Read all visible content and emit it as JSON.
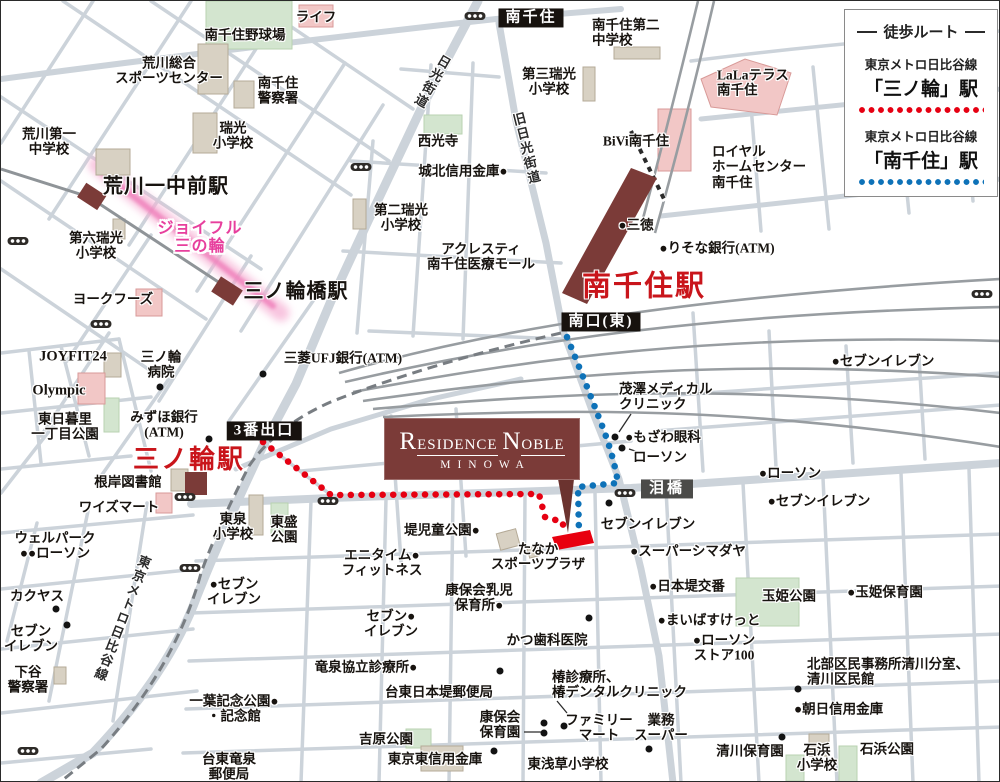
{
  "legend": {
    "title": "徒歩ルート",
    "entries": [
      {
        "line": "東京メトロ日比谷線",
        "station": "「三ノ輪」駅",
        "color": "#e60012"
      },
      {
        "line": "東京メトロ日比谷線",
        "station": "「南千住」駅",
        "color": "#0e72b8"
      }
    ]
  },
  "logo": {
    "part1": "R",
    "part2": "ESIDENCE",
    "part3": "N",
    "part4": "OBLE",
    "subtitle": "MINOWA"
  },
  "colors": {
    "red_route": "#e60012",
    "blue_route": "#0e72b8",
    "station_red": "#c9151b",
    "joyful_pink": "#e73f9d",
    "building_maroon": "#7b3b38"
  },
  "labels": [
    {
      "t": "ライフ",
      "x": 315,
      "y": 16
    },
    {
      "t": "南千住野球場",
      "x": 244,
      "y": 34
    },
    {
      "t": "荒川総合\nスポーツセンター",
      "x": 168,
      "y": 70
    },
    {
      "t": "南千住\n警察署",
      "x": 277,
      "y": 90
    },
    {
      "t": "荒川第一\n中学校",
      "x": 48,
      "y": 141
    },
    {
      "t": "瑞光\n小学校",
      "x": 232,
      "y": 135
    },
    {
      "t": "荒川一中前駅",
      "x": 165,
      "y": 186,
      "cls": "st"
    },
    {
      "t": "ジョイフル\n三の輪",
      "x": 199,
      "y": 237,
      "cls": "joyful"
    },
    {
      "t": "第六瑞光\n小学校",
      "x": 95,
      "y": 245
    },
    {
      "t": "ヨークフーズ",
      "x": 112,
      "y": 298
    },
    {
      "t": "三ノ輪橋駅",
      "x": 295,
      "y": 291,
      "cls": "st"
    },
    {
      "t": "南千住",
      "x": 530,
      "y": 17,
      "cls": "box"
    },
    {
      "t": "日光街道",
      "x": 430,
      "y": 80,
      "cls": "road",
      "rot": 30
    },
    {
      "t": "南千住第二\n中学校",
      "x": 591,
      "y": 32,
      "la": 1
    },
    {
      "t": "第三瑞光\n小学校",
      "x": 548,
      "y": 81
    },
    {
      "t": "第二瑞光\n小学校",
      "x": 400,
      "y": 217
    },
    {
      "t": "西光寺",
      "x": 437,
      "y": 140
    },
    {
      "t": "城北信用金庫●",
      "x": 462,
      "y": 170
    },
    {
      "t": "旧日光街道",
      "x": 524,
      "y": 148,
      "cls": "road",
      "rot": -14
    },
    {
      "t": "BiVi南千住",
      "x": 635,
      "y": 140
    },
    {
      "t": "LaLaテラス\n南千住",
      "x": 716,
      "y": 82,
      "la": 1
    },
    {
      "t": "ロイヤル\nホームセンター\n南千住",
      "x": 711,
      "y": 166,
      "la": 1
    },
    {
      "t": "●三徳",
      "x": 635,
      "y": 224
    },
    {
      "t": "●りそな銀行(ATM)",
      "x": 716,
      "y": 247
    },
    {
      "t": "アクレスティ\n南千住医療モール",
      "x": 480,
      "y": 256
    },
    {
      "t": "南千住駅",
      "x": 643,
      "y": 286,
      "cls": "stbig",
      "s": 29
    },
    {
      "t": "南口(東)",
      "x": 600,
      "y": 321,
      "cls": "box"
    },
    {
      "t": "JOYFIT24",
      "x": 72,
      "y": 356,
      "cls": "en"
    },
    {
      "t": "三ノ輪\n病院",
      "x": 160,
      "y": 364
    },
    {
      "t": "Olympic",
      "x": 58,
      "y": 390,
      "cls": "en"
    },
    {
      "t": "東日暮里\n一丁目公園",
      "x": 64,
      "y": 426
    },
    {
      "t": "みずほ銀行\n(ATM)",
      "x": 163,
      "y": 424
    },
    {
      "t": "3番出口",
      "x": 263,
      "y": 430,
      "cls": "box"
    },
    {
      "t": "三菱UFJ銀行(ATM)",
      "x": 342,
      "y": 357
    },
    {
      "t": "三ノ輪駅",
      "x": 188,
      "y": 459,
      "cls": "stbig",
      "s": 26
    },
    {
      "t": "根岸図書館",
      "x": 127,
      "y": 481
    },
    {
      "t": "ワイズマート",
      "x": 118,
      "y": 506
    },
    {
      "t": "茂澤メディカル\nクリニック",
      "x": 618,
      "y": 396,
      "la": 1
    },
    {
      "t": "●もざわ眼科",
      "x": 662,
      "y": 436
    },
    {
      "t": "ローソン",
      "x": 659,
      "y": 456
    },
    {
      "t": "泪橋",
      "x": 666,
      "y": 488,
      "cls": "boxgray"
    },
    {
      "t": "●ローソン",
      "x": 789,
      "y": 472
    },
    {
      "t": "●セブンイレブン",
      "x": 818,
      "y": 500
    },
    {
      "t": "●セブンイレブン",
      "x": 882,
      "y": 360
    },
    {
      "t": "東泉\n小学校",
      "x": 232,
      "y": 526
    },
    {
      "t": "東盛\n公園",
      "x": 283,
      "y": 529
    },
    {
      "t": "堤児童公園●",
      "x": 441,
      "y": 529
    },
    {
      "t": "たなか\nスポーツプラザ",
      "x": 537,
      "y": 556
    },
    {
      "t": "セブンイレブン",
      "x": 647,
      "y": 523
    },
    {
      "t": "●スーパーシマダヤ",
      "x": 687,
      "y": 550
    },
    {
      "t": "●日本堤交番",
      "x": 686,
      "y": 585
    },
    {
      "t": "玉姫公園",
      "x": 788,
      "y": 595
    },
    {
      "t": "●玉姫保育園",
      "x": 884,
      "y": 591
    },
    {
      "t": "●まいばすけっと",
      "x": 708,
      "y": 619
    },
    {
      "t": "●ローソン\nストア100",
      "x": 723,
      "y": 647
    },
    {
      "t": "エニタイム●\nフィットネス",
      "x": 381,
      "y": 562
    },
    {
      "t": "康保会乳児\n保育所●",
      "x": 478,
      "y": 597
    },
    {
      "t": "かつ歯科医院",
      "x": 546,
      "y": 639
    },
    {
      "t": "セブン●\nイレブン",
      "x": 390,
      "y": 623
    },
    {
      "t": "竜泉協立診療所●",
      "x": 365,
      "y": 666
    },
    {
      "t": "台東日本堤郵便局",
      "x": 438,
      "y": 691
    },
    {
      "t": "椿診療所、\n椿デンタルクリニック",
      "x": 551,
      "y": 684,
      "la": 1
    },
    {
      "t": "一葉記念公園●\n・記念館",
      "x": 233,
      "y": 708
    },
    {
      "t": "ウェルパーク\n●●ローソン",
      "x": 54,
      "y": 545
    },
    {
      "t": "カクヤス",
      "x": 36,
      "y": 595
    },
    {
      "t": "セブン\nイレブン",
      "x": 30,
      "y": 638
    },
    {
      "t": "下谷\n警察署",
      "x": 27,
      "y": 679
    },
    {
      "t": "東京メトロ日比谷線",
      "x": 120,
      "y": 617,
      "cls": "road",
      "rot": 21
    },
    {
      "t": "●セブン\nイレブン",
      "x": 233,
      "y": 591
    },
    {
      "t": "吉原公園",
      "x": 385,
      "y": 738
    },
    {
      "t": "康保会\n保育園",
      "x": 499,
      "y": 724
    },
    {
      "t": "ファミリー\nマート",
      "x": 598,
      "y": 727
    },
    {
      "t": "業務\nスーパー",
      "x": 660,
      "y": 727
    },
    {
      "t": "東京東信用金庫",
      "x": 434,
      "y": 758
    },
    {
      "t": "東浅草小学校",
      "x": 567,
      "y": 763
    },
    {
      "t": "清川保育園",
      "x": 749,
      "y": 750
    },
    {
      "t": "北部区民事務所清川分室、\n清川区民館",
      "x": 806,
      "y": 671,
      "la": 1
    },
    {
      "t": "●朝日信用金庫",
      "x": 793,
      "y": 708,
      "la": 1
    },
    {
      "t": "石浜\n小学校",
      "x": 816,
      "y": 757
    },
    {
      "t": "石浜公園",
      "x": 886,
      "y": 748
    },
    {
      "t": "台東竜泉\n郵便局",
      "x": 228,
      "y": 766
    }
  ],
  "dots": [
    [
      159,
      386
    ],
    [
      208,
      438
    ],
    [
      262,
      373
    ],
    [
      614,
      436
    ],
    [
      621,
      447
    ],
    [
      543,
      722
    ],
    [
      543,
      732
    ],
    [
      563,
      725
    ],
    [
      648,
      748
    ],
    [
      493,
      750
    ],
    [
      781,
      736
    ],
    [
      797,
      688
    ],
    [
      55,
      608
    ],
    [
      66,
      624
    ],
    [
      608,
      502
    ],
    [
      588,
      617
    ],
    [
      499,
      670
    ]
  ],
  "traffic_lights": [
    [
      17,
      240
    ],
    [
      100,
      323
    ],
    [
      360,
      166
    ],
    [
      474,
      15
    ],
    [
      184,
      496
    ],
    [
      327,
      500
    ],
    [
      624,
      492
    ],
    [
      981,
      293
    ],
    [
      27,
      750
    ],
    [
      189,
      567
    ]
  ]
}
